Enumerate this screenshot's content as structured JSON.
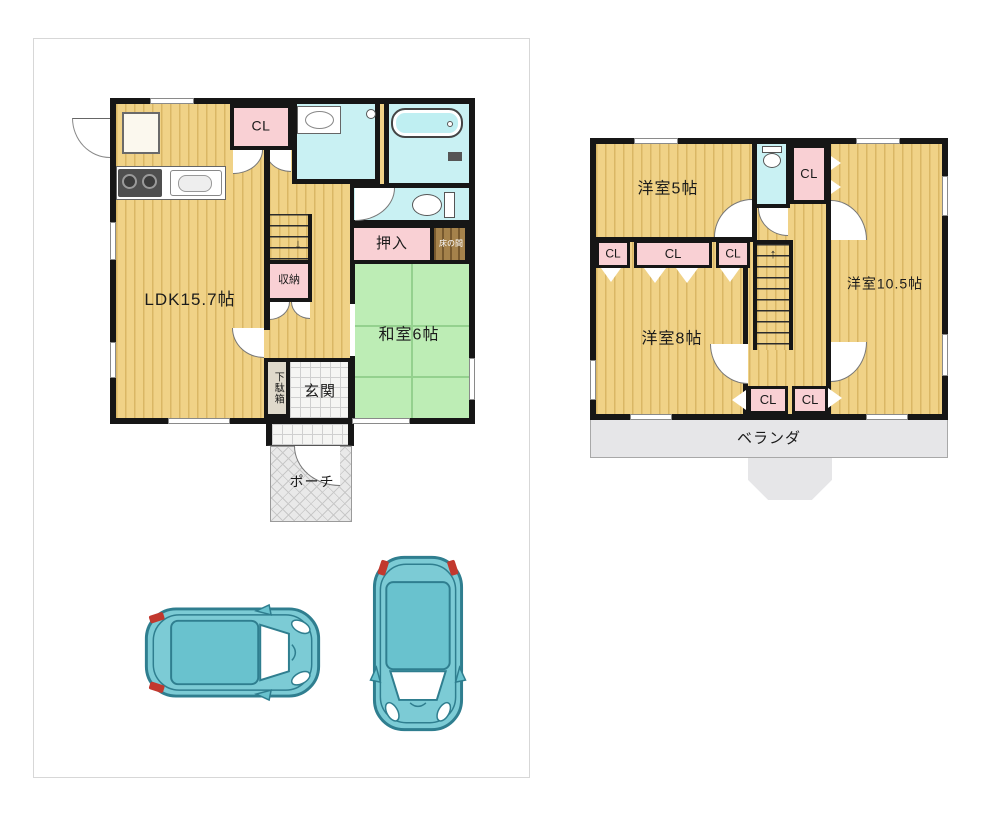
{
  "floor1": {
    "ldk_label": "LDK15.7帖",
    "cl_label": "CL",
    "oshiire_label": "押入",
    "tokonoma_label": "床の間",
    "shuno_label": "収納",
    "washitsu_label": "和室6帖",
    "getabako_label": "下駄箱",
    "genkan_label": "玄関",
    "porch_label": "ポーチ",
    "stairs_arrow": "↓"
  },
  "floor2": {
    "yoshitsu5_label": "洋室5帖",
    "yoshitsu105_label": "洋室10.5帖",
    "yoshitsu8_label": "洋室8帖",
    "cl_top_label": "CL",
    "cl_mid_left_label": "CL",
    "cl_mid_center_label": "CL",
    "cl_mid_right_label": "CL",
    "cl_bottom_left_label": "CL",
    "cl_bottom_right_label": "CL",
    "veranda_label": "ベランダ",
    "stairs_arrow": "↑"
  },
  "colors": {
    "wood_floor": "#F0D287",
    "closet_pink": "#F9D0D4",
    "wet_area_cyan": "#C9F1F3",
    "tatami_green": "#BDEDB5",
    "tokonoma_brown": "#A5824B",
    "exterior_gray": "#E6E6E8",
    "wall_black": "#161616",
    "car_body_teal": "#7CCBD5",
    "car_outline_teal": "#2F7E8F",
    "car_tail_red": "#C2382E"
  }
}
